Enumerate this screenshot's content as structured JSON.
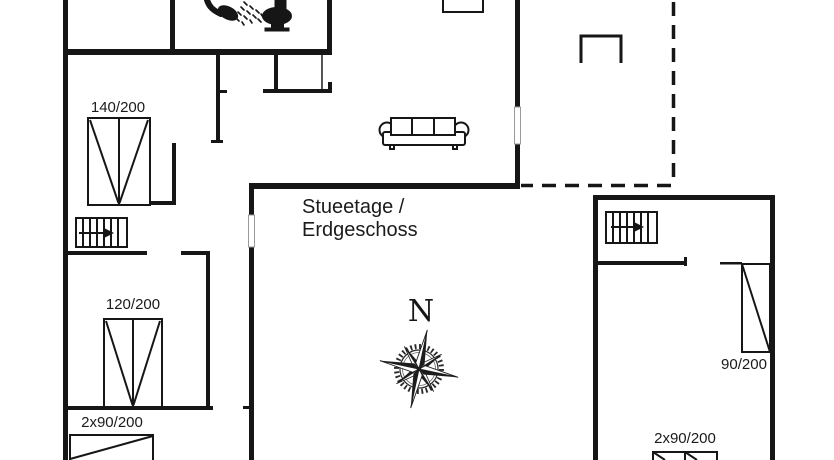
{
  "plan": {
    "title": {
      "line1": "Stueetage /",
      "line2": "Erdgeschoss"
    },
    "compass": {
      "north_label": "N"
    },
    "bed_labels": {
      "double_140": "140/200",
      "double_120": "120/200",
      "twin_left": "2x90/200",
      "single_90": "90/200",
      "twin_right": "2x90/200"
    },
    "icons": {
      "shower-icon": "shower head with spray",
      "toilet-icon": "toilet side view",
      "stairs-left-icon": "staircase with direction arrow",
      "stairs-right-icon": "staircase with direction arrow",
      "sofa-icon": "three-seat sofa",
      "compass-rose-icon": "eight point compass rose",
      "garden-bench-icon": "bench on terrace",
      "table-icon": "table at top edge"
    },
    "colors": {
      "wall": "#161616",
      "background": "#ffffff",
      "window_outline": "#999999"
    }
  }
}
